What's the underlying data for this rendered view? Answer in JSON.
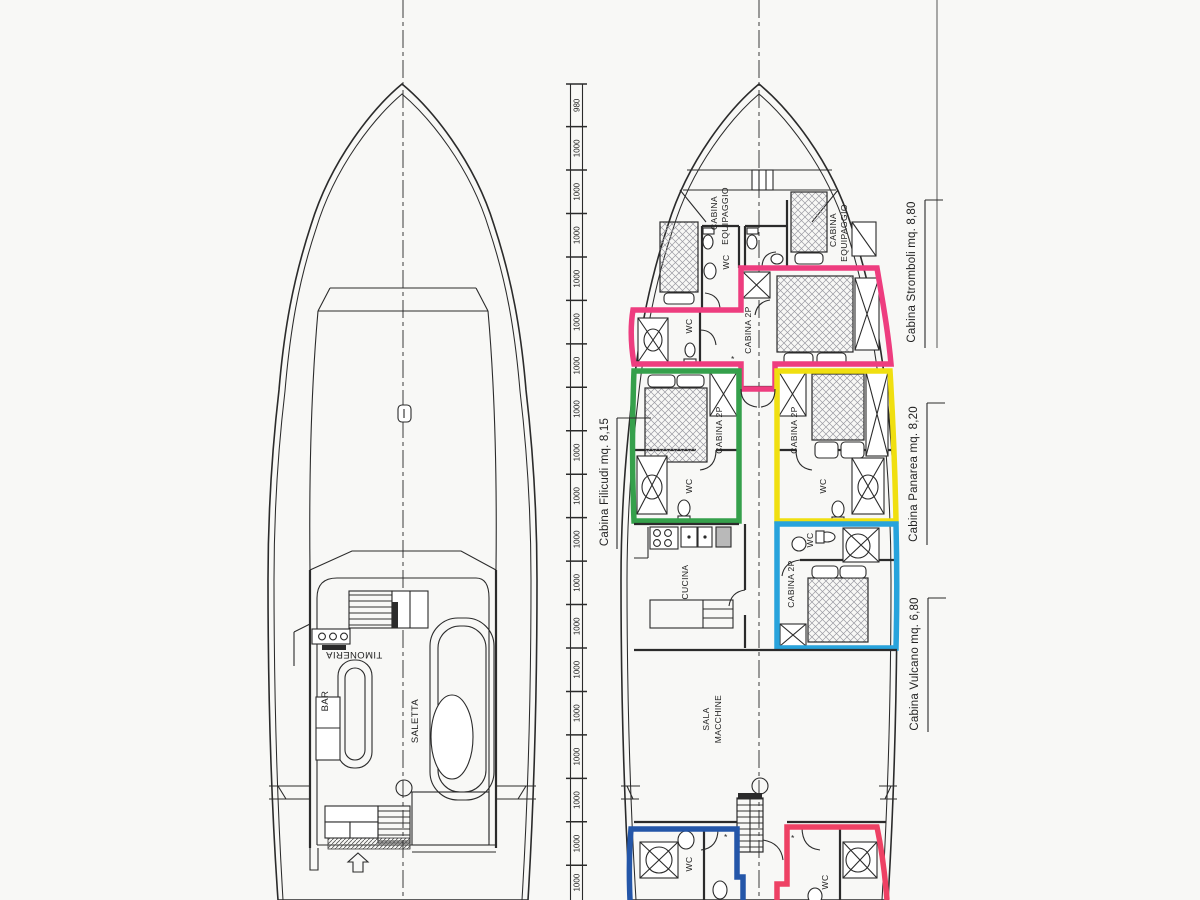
{
  "colors": {
    "ink": "#2b2b2b",
    "pink": "#ee3d7f",
    "red_pink": "#ee4164",
    "green": "#35a04b",
    "yellow": "#f0df10",
    "cyan": "#28a3dc",
    "navy": "#2456a8",
    "paper": "#f8f8f6"
  },
  "ruler": {
    "first": "980",
    "repeat": "1000",
    "segments": 19
  },
  "upper_deck": {
    "timoneria": "TIMONERIA",
    "bar": "BAR",
    "saletta": "SALETTA"
  },
  "lower_deck": {
    "cabina": "CABINA",
    "equipaggio": "EQUIPAGGIO",
    "wc": "WC",
    "cabina_2p": "CABINA 2P",
    "cucina": "CUCINA",
    "sala": "SALA",
    "macchine": "MACCHINE",
    "door_mark": "*"
  },
  "annotations": {
    "stromboli": "Cabina Stromboli mq. 8,80",
    "panarea": "Cabina Panarea mq. 8,20",
    "vulcano": "Cabina Vulcano mq. 6,80",
    "filicudi": "Cabina Filicudi mq. 8,15"
  }
}
